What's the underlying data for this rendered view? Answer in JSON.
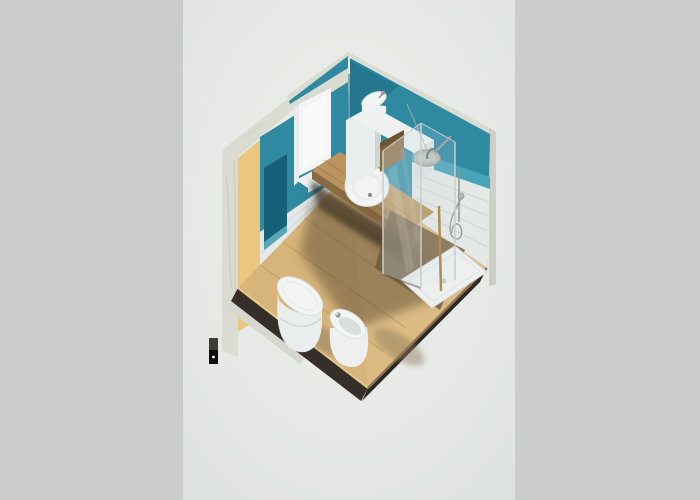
{
  "image": {
    "kind": "3d-axonometric-render",
    "subject": "small bathroom interior cutaway seen from above",
    "render_style": "isometric diamond view on plain backdrop"
  },
  "background": {
    "side_strip": "#cbcdcb",
    "center_band": "#dfe3df",
    "center_highlight": "#edefec"
  },
  "palette": {
    "bg_side": "#cbcdcb",
    "teal_main": "#2f89a1",
    "teal_dark": "#1c6781",
    "teal_light": "#4aa4b7",
    "teal_niche": "#17607a",
    "yellow_insulation": "#e9c77f",
    "marble_light": "#dadcd2",
    "marble_edge": "#cdd0c6",
    "marble_vein": "#c2c5b8",
    "tile_white": "#e4e8e6",
    "tile_line": "#d0d6d4",
    "wood_floor": "#d7b57a",
    "wood_plank_line": "#bb9659",
    "wood_counter": "#b9945e",
    "wood_counter_edge": "#8a6a42",
    "wood_niche": "#8a6a3e",
    "under_shadow": "#3d3222",
    "slab_dark": "#362e29",
    "fixture_white": "#f3f5f4",
    "fixture_shade": "#dde2e1",
    "chrome": "#939a97",
    "glass_tint": "rgba(208,226,231,0.30)",
    "glass_tint_light": "rgba(208,226,231,0.16)",
    "glass_edge": "#c9cecd",
    "brass_profile": "#b08a52",
    "shadow_warm": "#8b7a5a"
  },
  "scene": {
    "walls": [
      "back-left wall with window (teal paint over white tile)",
      "back-right wall with shower zone (teal paint, light tile)",
      "section cut showing marble exterior finish and yellow insulation layer"
    ],
    "elements": [
      "window",
      "wall-niche-shelf",
      "corner-hand-basin",
      "storage-niche",
      "vanity-counter",
      "round-washbasin",
      "glass-shower-enclosure",
      "rain-shower-head",
      "hand-shower-on-rail",
      "shower-tray",
      "wall-hung-toilet",
      "bidet",
      "wood-plank-floor",
      "floor-slab-edge",
      "section-marker"
    ]
  }
}
